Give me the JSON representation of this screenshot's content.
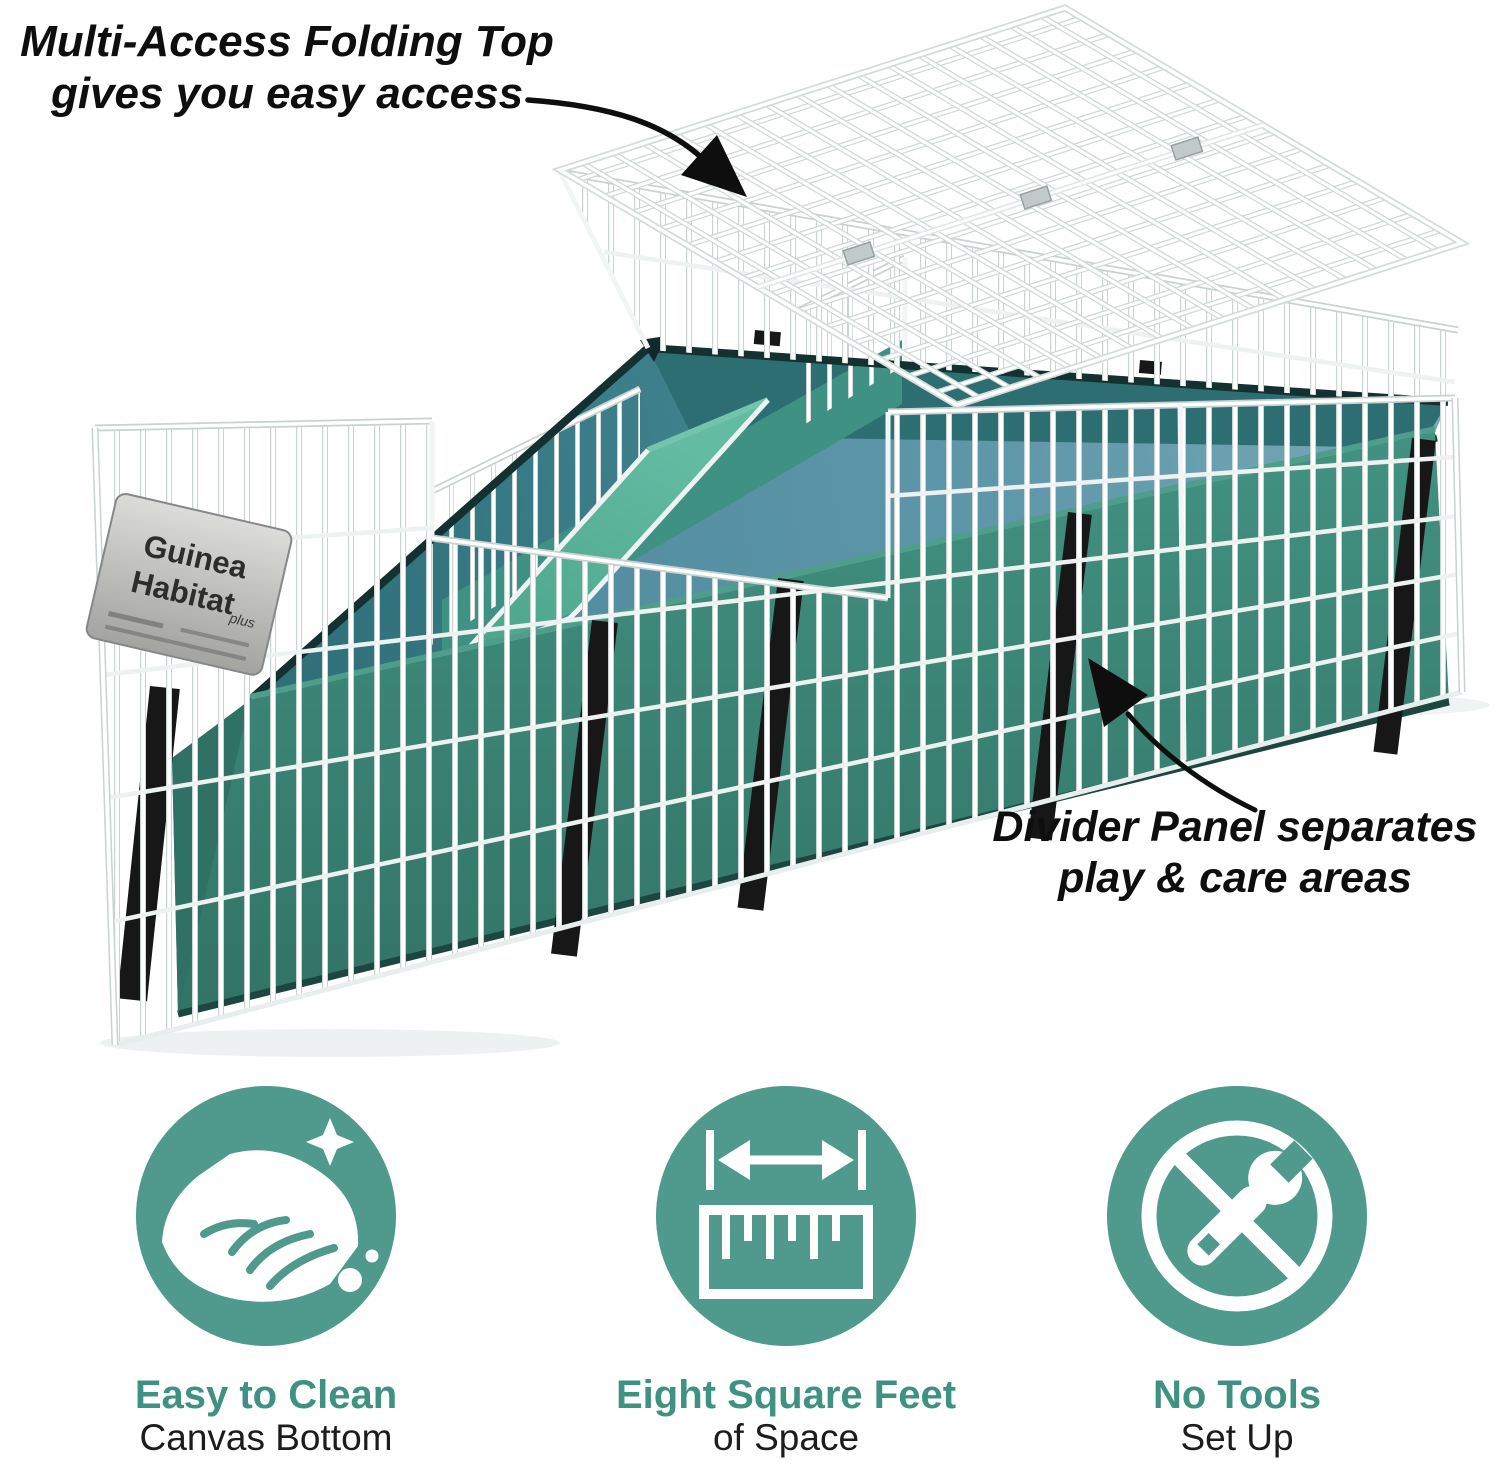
{
  "annotations": {
    "folding_top": {
      "line1": "Multi-Access Folding Top",
      "line2": "gives you easy access"
    },
    "divider": {
      "line1": "Divider Panel separates",
      "line2": "play & care areas"
    }
  },
  "cage": {
    "label_line1": "Guinea",
    "label_line2": "Habitat",
    "label_plus": "plus"
  },
  "features": [
    {
      "title": "Easy to Clean",
      "subtitle": "Canvas Bottom",
      "icon": "hand-wipe-icon"
    },
    {
      "title": "Eight Square Feet",
      "subtitle": "of Space",
      "icon": "ruler-icon"
    },
    {
      "title": "No Tools",
      "subtitle": "Set Up",
      "icon": "no-tools-icon"
    }
  ],
  "colors": {
    "accent_teal": "#4f9a8c",
    "title_teal": "#3f9181",
    "canvas_green": "#3b8577",
    "floor_blue": "#5892a6",
    "ramp_green": "#5bb49c",
    "wire_white": "#ffffff",
    "strap_black": "#171717",
    "annotation_black": "#0e0e0e"
  }
}
